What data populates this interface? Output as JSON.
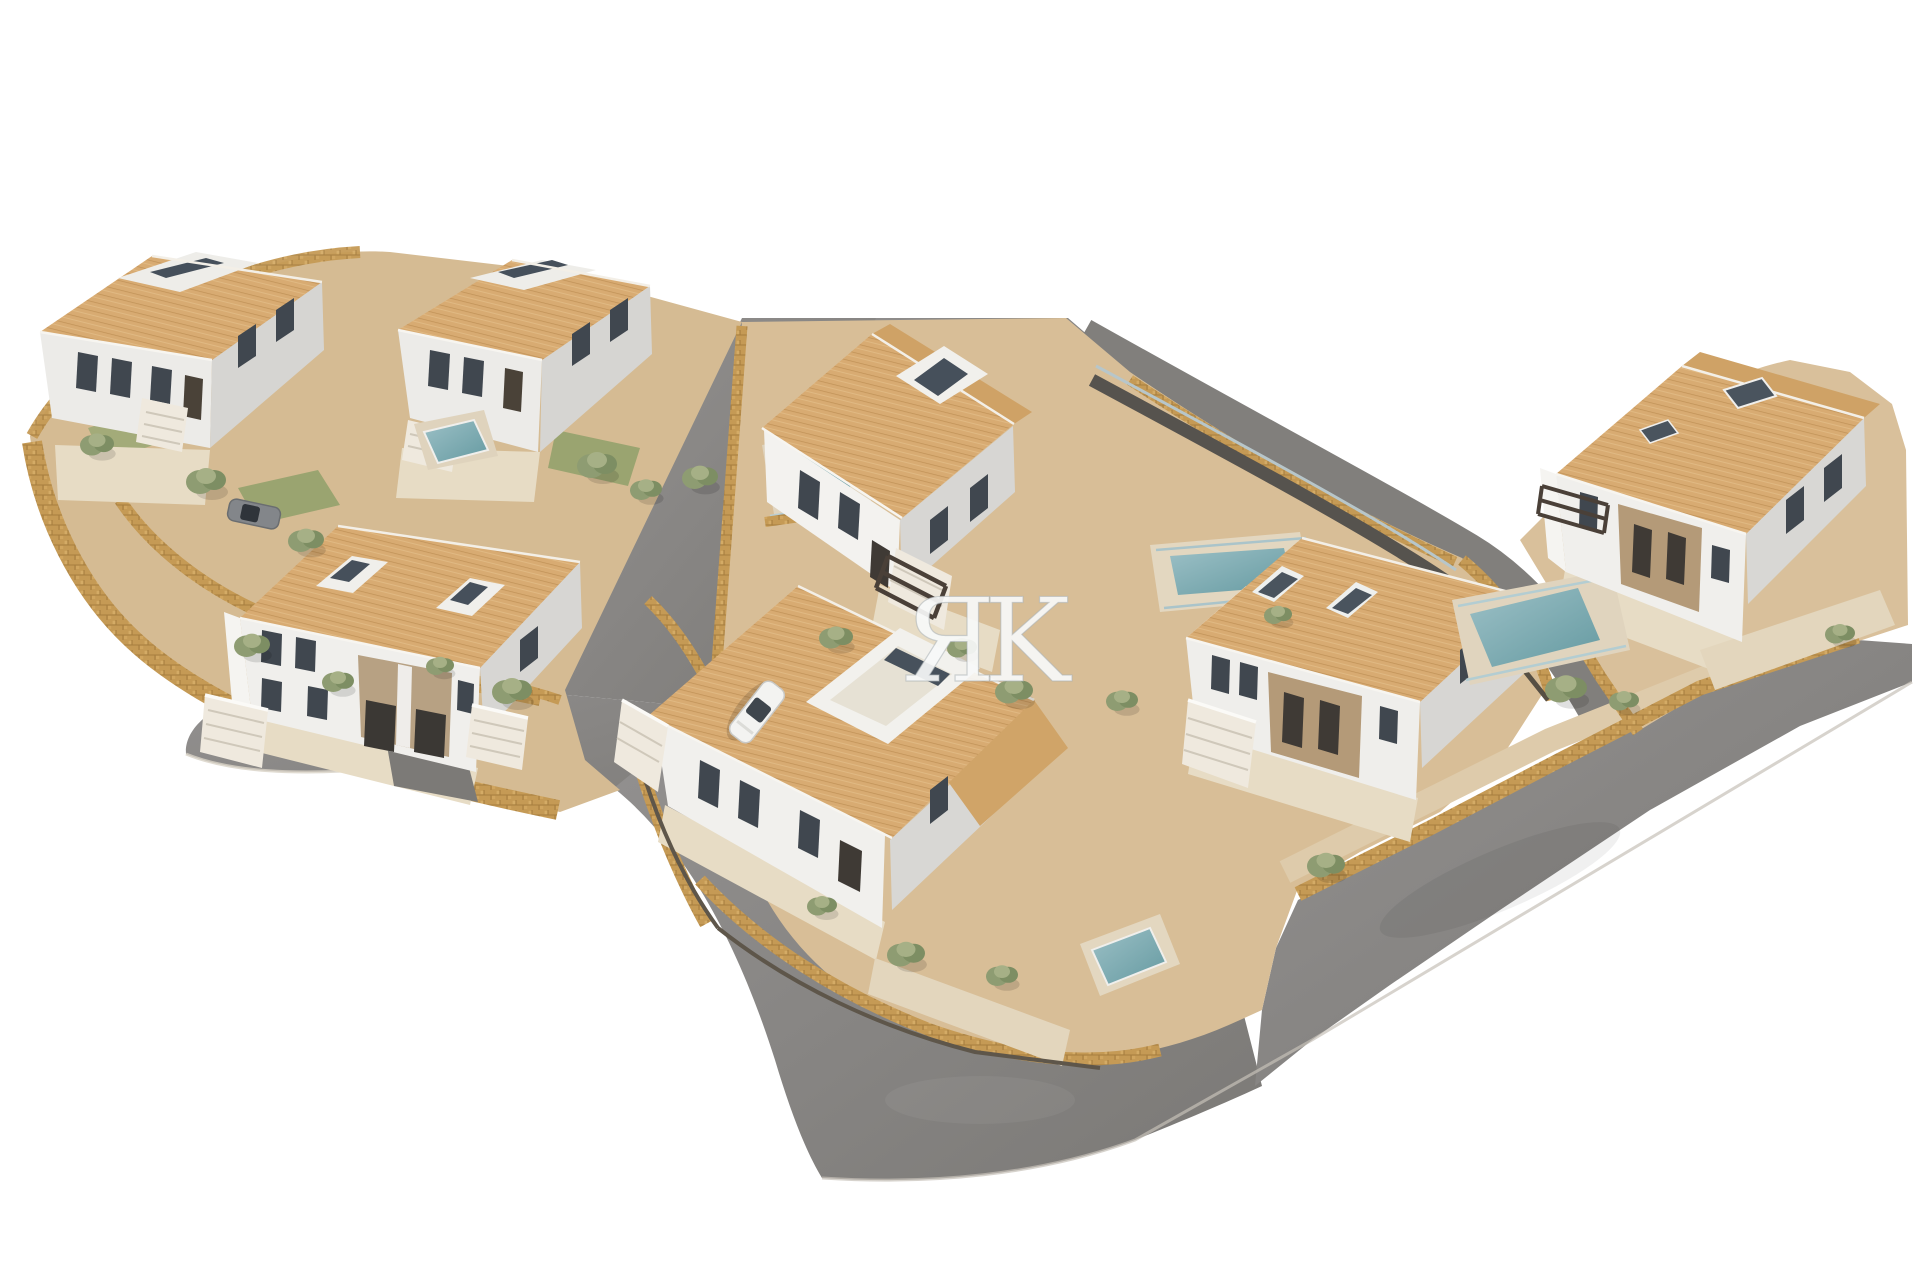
{
  "scene": {
    "type": "architectural-3d-aerial-render",
    "description": "Aerial 3D rendering of a Mediterranean hillside villa development: seven white two-storey houses with terracotta tiled roofs, golden stone retaining walls, beige terraces, private pools, curved grey asphalt roads, two parked cars, on a pure white background",
    "watermark": "ЯK",
    "background": "#ffffff"
  },
  "palette": {
    "roof": "#d8ab72",
    "roof_shade": "#cfa266",
    "wall_white": "#f3f2ef",
    "wall_shade": "#d7d6d3",
    "stone_wall": "#c59a55",
    "terrace": "#d8be97",
    "paving": "#e7dcc5",
    "road": "#8b8987",
    "pool_water": "#74a1a8",
    "vegetation": "#8e9c72",
    "fence_dark": "#5e564a",
    "window": "#40474f",
    "accent_facade": "#b49a78"
  },
  "objects": {
    "buildings": [
      {
        "id": "villa-1",
        "label": "semi-detached villa top-left",
        "area": "x35-325 y250-455"
      },
      {
        "id": "villa-2",
        "label": "semi-detached villa top-centre-left",
        "area": "x395-650 y255-455"
      },
      {
        "id": "villa-3",
        "label": "large double villa centre-left",
        "area": "x220-580 y520-800"
      },
      {
        "id": "villa-4",
        "label": "villa centre with pergola",
        "area": "x760-1015 y320-630"
      },
      {
        "id": "villa-5",
        "label": "villa bottom-centre with roof terrace",
        "area": "x645-1065 y585-930"
      },
      {
        "id": "villa-6",
        "label": "paired villa centre-right",
        "area": "x1185-1535 y540-800"
      },
      {
        "id": "villa-7",
        "label": "villa far right",
        "area": "x1540-1880 y350-645"
      }
    ],
    "pools": [
      {
        "id": "pool-1",
        "at": "x425-490 y420-465"
      },
      {
        "id": "pool-2",
        "at": "x775-855 y445-510"
      },
      {
        "id": "pool-3",
        "at": "x1170-1295 y545-595"
      },
      {
        "id": "pool-4",
        "at": "x1090-1165 y925-985"
      },
      {
        "id": "pool-5",
        "at": "x1470-1600 y585-670"
      }
    ],
    "cars": [
      {
        "id": "car-white",
        "color": "#f3f3f1",
        "at": "x725-790 y680-745"
      },
      {
        "id": "car-gray",
        "color": "#83868a",
        "at": "x228-280 y495-535"
      }
    ],
    "roads": [
      "top clipped road",
      "left branch to crescent loop",
      "crescent cul-de-sac",
      "loop around bottom villa",
      "wide diagonal road bottom-right"
    ]
  }
}
